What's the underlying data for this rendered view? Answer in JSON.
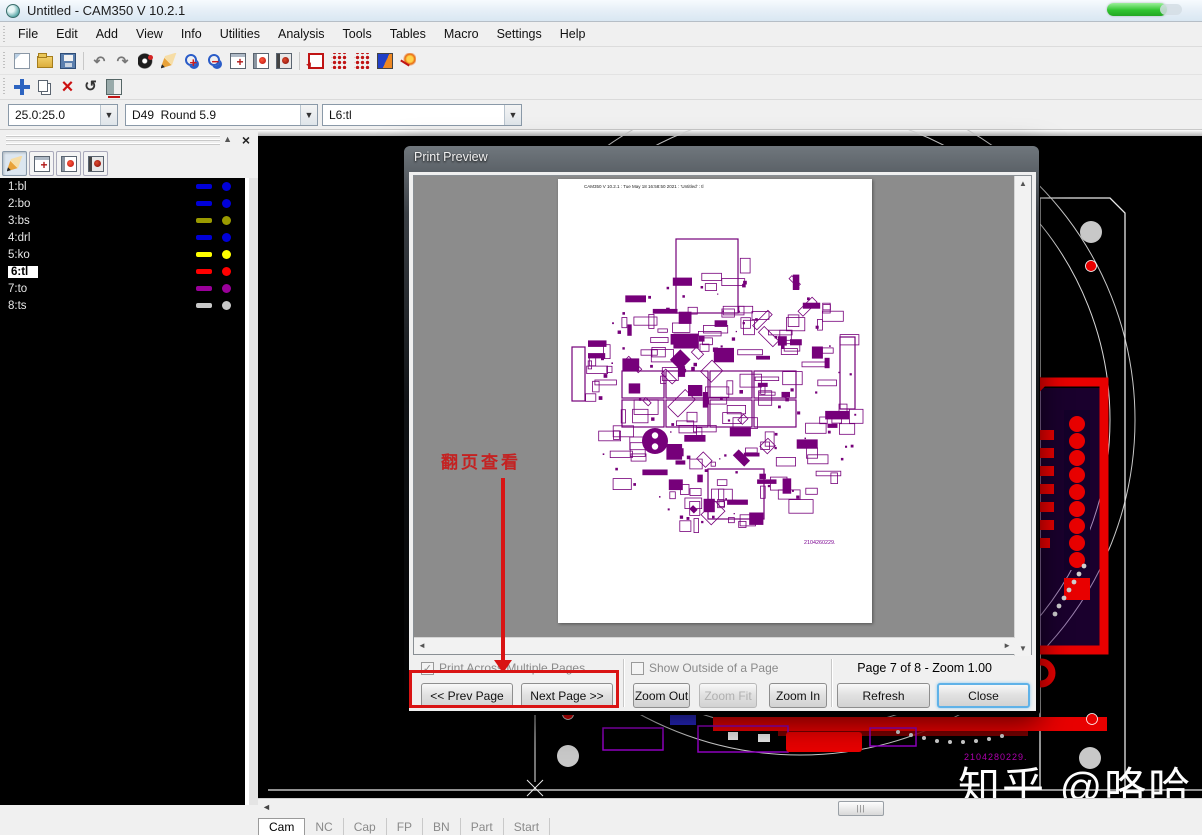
{
  "window": {
    "title": "Untitled - CAM350 V 10.2.1"
  },
  "menu": {
    "items": [
      "File",
      "Edit",
      "Add",
      "View",
      "Info",
      "Utilities",
      "Analysis",
      "Tools",
      "Tables",
      "Macro",
      "Settings",
      "Help"
    ]
  },
  "toolbar_main": {
    "icons": [
      "new",
      "open",
      "save",
      "|",
      "undo",
      "redo",
      "view-layers",
      "clean",
      "zoom-in",
      "zoom-out",
      "window-add",
      "film-red",
      "film-dark",
      "|",
      "pad-edit",
      "grid-dots",
      "grid-dots2",
      "color-palette",
      "net-highlight"
    ]
  },
  "toolbar_edit": {
    "icons": [
      "move",
      "copy",
      "delete",
      "rotate",
      "mirror"
    ]
  },
  "combos": {
    "grid": "25.0:25.0",
    "dcode": "D49  Round 5.9",
    "layer": "L6:tl"
  },
  "layers_panel": {
    "toolbar": [
      "clean",
      "window-add",
      "film-red",
      "film-dark"
    ],
    "layers": [
      {
        "label": "1:bl",
        "color": "#0000d8",
        "selected": false
      },
      {
        "label": "2:bo",
        "color": "#0000d8",
        "selected": false
      },
      {
        "label": "3:bs",
        "color": "#9a9a00",
        "selected": false
      },
      {
        "label": "4:drl",
        "color": "#0000d8",
        "selected": false
      },
      {
        "label": "5:ko",
        "color": "#ffff00",
        "selected": false
      },
      {
        "label": "6:tl",
        "color": "#ff0000",
        "selected": true
      },
      {
        "label": "7:to",
        "color": "#9a009a",
        "selected": false
      },
      {
        "label": "8:ts",
        "color": "#c8c8c8",
        "selected": false
      }
    ]
  },
  "dialog": {
    "title": "Print Preview",
    "page_header": "CAM350 V 10.2.1 : Tue May 18 16:58:50 2021 : 'Untitled' : tl",
    "page_code": "2104260229.",
    "print_across_label": "Print Across Multiple Pages",
    "print_across_checked": "✓",
    "show_outside_label": "Show Outside of a Page",
    "page_status": "Page 7 of 8 - Zoom 1.00",
    "prev_label": "<< Prev Page",
    "next_label": "Next Page >>",
    "zoom_out_label": "Zoom Out",
    "zoom_fit_label": "Zoom Fit",
    "zoom_in_label": "Zoom In",
    "refresh_label": "Refresh",
    "close_label": "Close"
  },
  "annotation": {
    "text": "翻页查看"
  },
  "canvas": {
    "board_code": "2104280229.",
    "watermark": "知乎 @咯哈"
  },
  "bottom_bar": {
    "tabs": [
      "Cam",
      "NC",
      "Cap",
      "FP",
      "BN",
      "Part",
      "Start"
    ],
    "active_tab": "Cam"
  },
  "colors": {
    "annotation_red": "#d91414",
    "silkscreen_purple": "#76007a",
    "board_red": "#e80000",
    "code_magenta": "#b000b0"
  }
}
